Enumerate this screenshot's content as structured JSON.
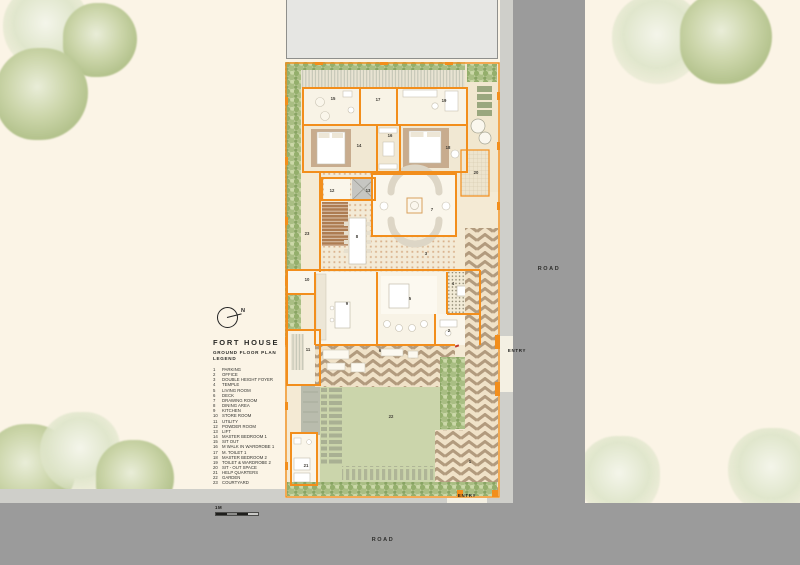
{
  "title_block": {
    "title": "FORT HOUSE",
    "subtitle_line1": "GROUND FLOOR PLAN",
    "subtitle_line2": "LEGEND",
    "north_label": "N",
    "scale_label": "1M"
  },
  "labels": {
    "road_right": "ROAD",
    "road_bottom": "ROAD",
    "entry_side": "ENTRY",
    "entry_bottom": "ENTRY"
  },
  "legend": {
    "items": [
      {
        "num": "1",
        "label": "PARKING"
      },
      {
        "num": "2",
        "label": "OFFICE"
      },
      {
        "num": "3",
        "label": "DOUBLE HEIGHT FOYER"
      },
      {
        "num": "4",
        "label": "TEMPLE"
      },
      {
        "num": "5",
        "label": "LIVING ROOM"
      },
      {
        "num": "6",
        "label": "DECK"
      },
      {
        "num": "7",
        "label": "DRAWING ROOM"
      },
      {
        "num": "8",
        "label": "DINING AREA"
      },
      {
        "num": "9",
        "label": "KITCHEN"
      },
      {
        "num": "10",
        "label": "STORE ROOM"
      },
      {
        "num": "11",
        "label": "UTILITY"
      },
      {
        "num": "12",
        "label": "POWDER ROOM"
      },
      {
        "num": "13",
        "label": "LIFT"
      },
      {
        "num": "14",
        "label": "MASTER BEDROOM 1"
      },
      {
        "num": "15",
        "label": "SIT OUT"
      },
      {
        "num": "16",
        "label": "M WALK IN WARDROBE 1"
      },
      {
        "num": "17",
        "label": "M. TOILET 1"
      },
      {
        "num": "18",
        "label": "MASTER BEDROOM 2"
      },
      {
        "num": "19",
        "label": "TOILET & WARDROBE 2"
      },
      {
        "num": "20",
        "label": "SIT - OUT SPACE"
      },
      {
        "num": "21",
        "label": "HELP QUARTERS"
      },
      {
        "num": "22",
        "label": "GARDEN"
      },
      {
        "num": "23",
        "label": "COURTYARD"
      }
    ]
  },
  "colors": {
    "canvas_cream": "#FBF4E6",
    "wall_orange": "#F28E1C",
    "road_gray": "#9B9B9B",
    "sidewalk_gray": "#CFCFCA",
    "plan_cream": "#F4EAD4",
    "lawn_green": "#CBD5AB",
    "hedge_green": "#A9BE83",
    "deck_tan": "#B29B7E",
    "stair_brown": "#AD7C52",
    "rug_tan": "#C8AC8E",
    "tree_green": "#C6D1A4"
  }
}
